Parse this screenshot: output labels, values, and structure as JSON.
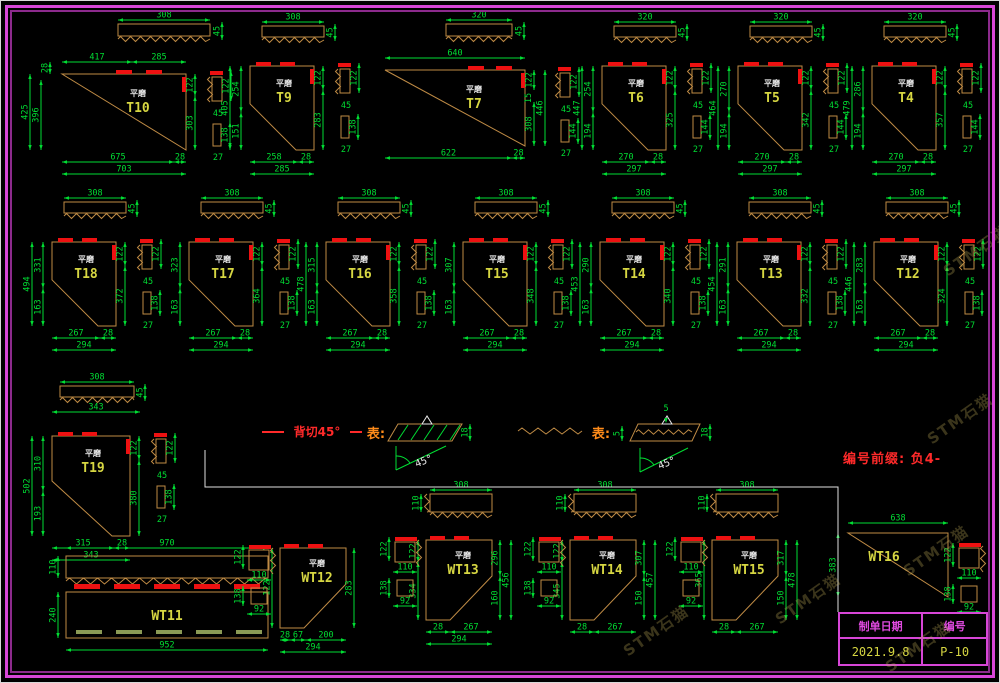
{
  "colors": {
    "background": "#000000",
    "border": "#d746d7",
    "dimension": "#00dd33",
    "outline": "#bf8b45",
    "cap": "#ee1111",
    "label": "#d6d642",
    "sublabel": "#e9e9e9",
    "legend_red": "#ff2a2a",
    "legend_orange": "#ff8c1a",
    "title_text": "#e04ae0",
    "title_value": "#d6d642",
    "wt11_dash": "#8a9a55"
  },
  "note": {
    "text": "编号前缀: 负4-"
  },
  "watermark": {
    "text": "STM石猫"
  },
  "title_block": {
    "date_label": "制单日期",
    "date_value": "2021.9.8",
    "no_label": "编号",
    "no_value": "P-10"
  },
  "legend": {
    "item1": {
      "label": "背切45°",
      "rep": "表:",
      "dim_right": "18",
      "angle": "45°"
    },
    "item2": {
      "rep": "表:",
      "dim_left": "5",
      "dim_top": "5",
      "dim_right": "18",
      "angle": "45°"
    }
  },
  "figures": [
    {
      "id": "T10",
      "sublabel": "平磨",
      "strip": {
        "w": "308",
        "h": "45"
      },
      "dims": {
        "top": [
          "417",
          "285"
        ],
        "left": [
          "28",
          "425",
          "396"
        ],
        "right": [
          "122",
          "303"
        ],
        "bottom": [
          "675",
          "28",
          "703"
        ],
        "side": [
          "122",
          "45",
          "138",
          "27"
        ]
      }
    },
    {
      "id": "T9",
      "sublabel": "平磨",
      "strip": {
        "w": "308",
        "h": "45"
      },
      "dims": {
        "left": [
          "405",
          "254",
          "151"
        ],
        "right": [
          "122",
          "283"
        ],
        "bottom": [
          "258",
          "28",
          "285"
        ],
        "side": [
          "122",
          "45",
          "138",
          "27"
        ]
      }
    },
    {
      "id": "T7",
      "sublabel": "平磨",
      "strip": {
        "w": "320",
        "h": "45"
      },
      "dims": {
        "top": [
          "640"
        ],
        "right": [
          "122",
          "15",
          "308",
          "446"
        ],
        "bottom": [
          "622",
          "28"
        ],
        "side": [
          "122",
          "45",
          "144",
          "27"
        ]
      }
    },
    {
      "id": "T6",
      "sublabel": "平磨",
      "strip": {
        "w": "320",
        "h": "45"
      },
      "dims": {
        "left": [
          "447",
          "254",
          "194"
        ],
        "right": [
          "122",
          "325"
        ],
        "bottom": [
          "270",
          "28",
          "297"
        ],
        "side": [
          "122",
          "45",
          "144",
          "27"
        ]
      }
    },
    {
      "id": "T5",
      "sublabel": "平磨",
      "strip": {
        "w": "320",
        "h": "45"
      },
      "dims": {
        "left": [
          "464",
          "270",
          "194"
        ],
        "right": [
          "122",
          "342"
        ],
        "bottom": [
          "270",
          "28",
          "297"
        ],
        "side": [
          "122",
          "45",
          "144",
          "27"
        ]
      }
    },
    {
      "id": "T4",
      "sublabel": "平磨",
      "strip": {
        "w": "320",
        "h": "45"
      },
      "dims": {
        "left": [
          "479",
          "286",
          "194"
        ],
        "right": [
          "122",
          "357"
        ],
        "bottom": [
          "270",
          "28",
          "297"
        ],
        "side": [
          "122",
          "45",
          "144",
          "27"
        ]
      }
    },
    {
      "id": "T18",
      "sublabel": "平磨",
      "strip": {
        "w": "308",
        "h": "45"
      },
      "dims": {
        "left": [
          "494",
          "331",
          "163"
        ],
        "right": [
          "122",
          "372"
        ],
        "bottom": [
          "267",
          "28",
          "294"
        ],
        "side": [
          "122",
          "45",
          "138",
          "27"
        ]
      }
    },
    {
      "id": "T17",
      "sublabel": "平磨",
      "strip": {
        "w": "308",
        "h": "45"
      },
      "dims": {
        "left": [
          "323",
          "163"
        ],
        "right": [
          "122",
          "364"
        ],
        "bottom": [
          "267",
          "28",
          "294"
        ],
        "side": [
          "122",
          "45",
          "138",
          "27"
        ]
      }
    },
    {
      "id": "T16",
      "sublabel": "平磨",
      "strip": {
        "w": "308",
        "h": "45"
      },
      "dims": {
        "left": [
          "478",
          "315",
          "163"
        ],
        "right": [
          "122",
          "358"
        ],
        "bottom": [
          "267",
          "28",
          "294"
        ],
        "side": [
          "122",
          "45",
          "138",
          "27"
        ]
      }
    },
    {
      "id": "T15",
      "sublabel": "平磨",
      "strip": {
        "w": "308",
        "h": "45"
      },
      "dims": {
        "left": [
          "307",
          "163"
        ],
        "right": [
          "122",
          "348"
        ],
        "bottom": [
          "267",
          "28",
          "294"
        ],
        "side": [
          "122",
          "45",
          "138",
          "27"
        ]
      }
    },
    {
      "id": "T14",
      "sublabel": "平磨",
      "strip": {
        "w": "308",
        "h": "45"
      },
      "dims": {
        "left": [
          "453",
          "290",
          "163"
        ],
        "right": [
          "122",
          "340"
        ],
        "bottom": [
          "267",
          "28",
          "294"
        ],
        "side": [
          "122",
          "45",
          "138",
          "27"
        ]
      }
    },
    {
      "id": "T13",
      "sublabel": "平磨",
      "strip": {
        "w": "308",
        "h": "45"
      },
      "dims": {
        "left": [
          "454",
          "291",
          "163"
        ],
        "right": [
          "122",
          "332"
        ],
        "bottom": [
          "267",
          "28",
          "294"
        ],
        "side": [
          "122",
          "45",
          "138",
          "27"
        ]
      }
    },
    {
      "id": "T12",
      "sublabel": "平磨",
      "strip": {
        "w": "308",
        "h": "45"
      },
      "dims": {
        "left": [
          "446",
          "283",
          "163"
        ],
        "right": [
          "122",
          "324"
        ],
        "bottom": [
          "267",
          "28",
          "294"
        ],
        "side": [
          "122",
          "45",
          "138",
          "27"
        ]
      }
    },
    {
      "id": "T19",
      "sublabel": "平磨",
      "strip": {
        "w": "308",
        "h": "45",
        "below": "343"
      },
      "dims": {
        "left": [
          "502",
          "310",
          "193"
        ],
        "right": [
          "122",
          "380"
        ],
        "bottom": [
          "315",
          "28",
          "343"
        ],
        "side": [
          "122",
          "45",
          "138",
          "27"
        ]
      }
    },
    {
      "id": "WT11",
      "sublabel": "",
      "dims": {
        "top": [
          "970"
        ],
        "left": [
          "110",
          "240"
        ],
        "bottom": [
          "952"
        ]
      }
    },
    {
      "id": "WT12",
      "sublabel": "平磨",
      "dims": {
        "left": [
          "122"
        ],
        "right": [
          "283"
        ],
        "bottom": [
          "28",
          "67",
          "200",
          "294"
        ],
        "side": [
          "122",
          "110",
          "138",
          "92"
        ]
      }
    },
    {
      "id": "WT13",
      "sublabel": "平磨",
      "strip": {
        "w": "308",
        "h": "110"
      },
      "dims": {
        "left": [
          "122",
          "334"
        ],
        "right": [
          "296",
          "160",
          "456"
        ],
        "bottom": [
          "28",
          "267",
          "294"
        ],
        "side": [
          "122",
          "110",
          "138",
          "92"
        ]
      }
    },
    {
      "id": "WT14",
      "sublabel": "平磨",
      "strip": {
        "w": "308",
        "h": "110"
      },
      "dims": {
        "left": [
          "122",
          "345"
        ],
        "right": [
          "307",
          "150",
          "457"
        ],
        "bottom": [
          "28",
          "267"
        ],
        "side": [
          "122",
          "110",
          "138",
          "92"
        ]
      }
    },
    {
      "id": "WT15",
      "sublabel": "平磨",
      "strip": {
        "w": "308",
        "h": "110"
      },
      "dims": {
        "left": [
          "365"
        ],
        "right": [
          "317",
          "150",
          "478"
        ],
        "bottom": [
          "28",
          "267"
        ],
        "side": [
          "122",
          "110",
          "92"
        ]
      }
    },
    {
      "id": "WT16",
      "sublabel": "",
      "dims": {
        "top": [
          "638"
        ],
        "left": [
          "383"
        ],
        "side": [
          "122",
          "110",
          "138",
          "92"
        ]
      }
    }
  ]
}
